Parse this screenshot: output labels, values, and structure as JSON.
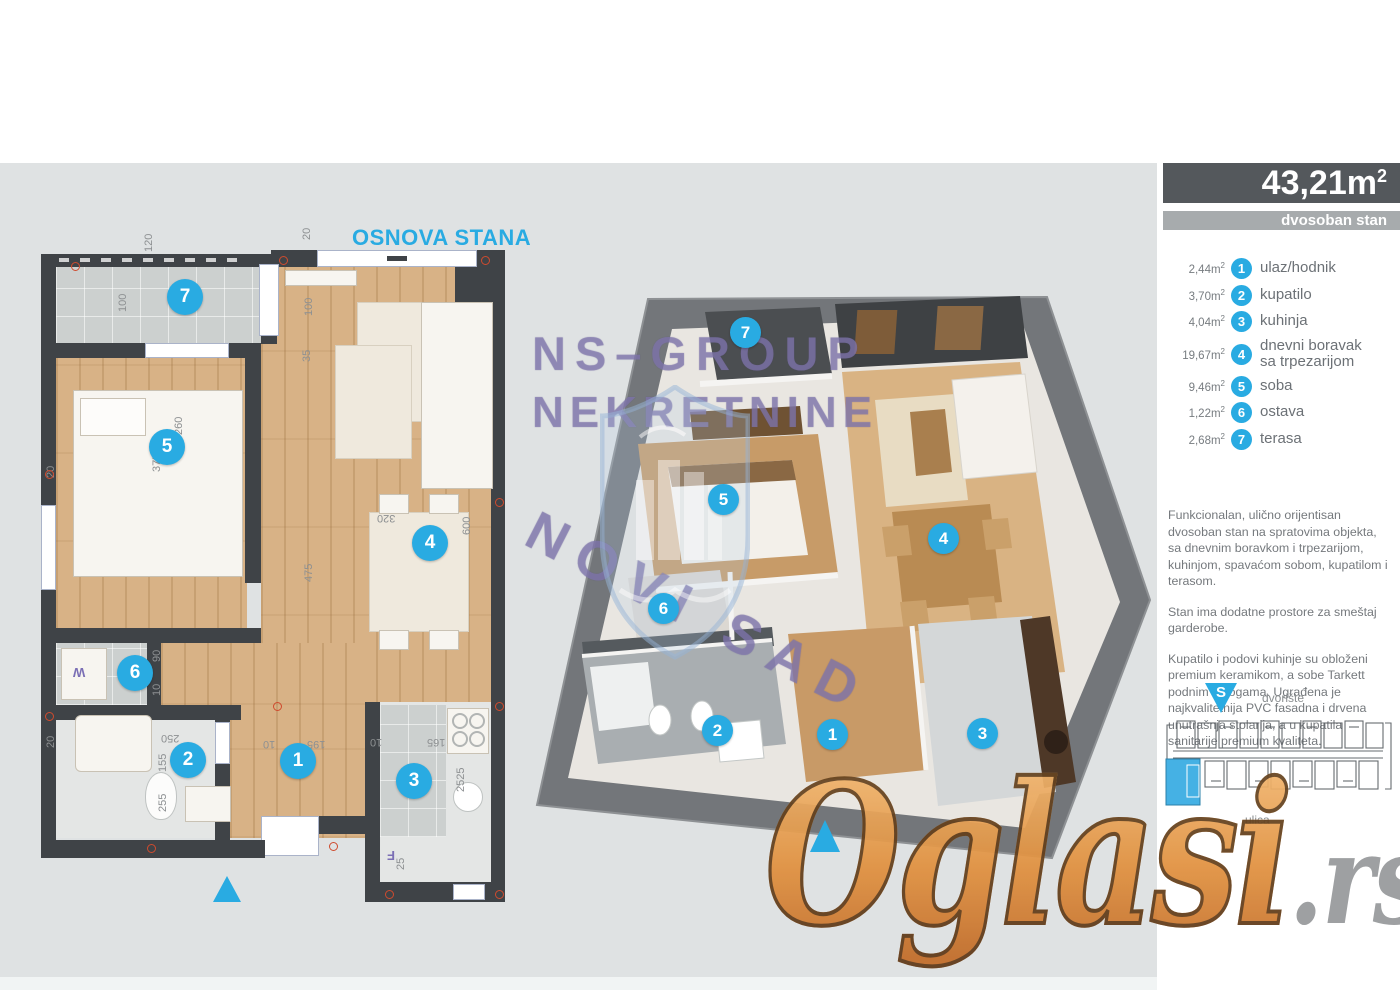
{
  "colors": {
    "accent": "#29abe2",
    "dark_bar": "#54585c",
    "light_bar": "#a7abad",
    "wall": "#3f4347",
    "orange": "#e1913f"
  },
  "title_2d": "OSNOVA STANA",
  "header": {
    "area": "43,21m",
    "sup": "2",
    "type": "dvosoban stan"
  },
  "rooms": [
    {
      "num": "1",
      "area": "2,44m",
      "label": "ulaz/hodnik"
    },
    {
      "num": "2",
      "area": "3,70m",
      "label": "kupatilo"
    },
    {
      "num": "3",
      "area": "4,04m",
      "label": "kuhinja"
    },
    {
      "num": "4",
      "area": "19,67m",
      "label": "dnevni boravak",
      "label2": "sa trpezarijom"
    },
    {
      "num": "5",
      "area": "9,46m",
      "label": "soba"
    },
    {
      "num": "6",
      "area": "1,22m",
      "label": "ostava"
    },
    {
      "num": "7",
      "area": "2,68m",
      "label": "terasa"
    }
  ],
  "description": {
    "p1": "Funkcionalan, ulično orijentisan dvosoban stan na spratovima objekta, sa dnevnim boravkom i trpezarijom, kuhinjom, spavaćom sobom, kupatilom i terasom.",
    "p2": "Stan ima dodatne prostore za smeštaj garderobe.",
    "p3": "Kupatilo i podovi kuhinje su obloženi premium keramikom, a sobe Tarkett podnim oblogama. Ugrađena je najkvalitetnija PVC fasadna i drvena unutrašnja stolarija, a u kupatila sanitarije premium kvaliteta."
  },
  "compass_label": "S",
  "site": {
    "top_label": "dvorište",
    "bottom_label": "ulica"
  },
  "watermark3d": {
    "line1": "NS–GROUP",
    "line2": "NEKRETNINE",
    "line3": "NOVI SAD"
  },
  "brand": {
    "name": "Oglasi",
    "tld": ".rs"
  },
  "dims": [
    "120",
    "20",
    "100",
    "100",
    "35",
    "260",
    "375",
    "475",
    "320",
    "600",
    "20",
    "90",
    "10",
    "20",
    "250",
    "155",
    "255",
    "195",
    "10",
    "10",
    "165",
    "2525",
    "25"
  ],
  "labels": {
    "washer": "W",
    "fridge": "F"
  }
}
